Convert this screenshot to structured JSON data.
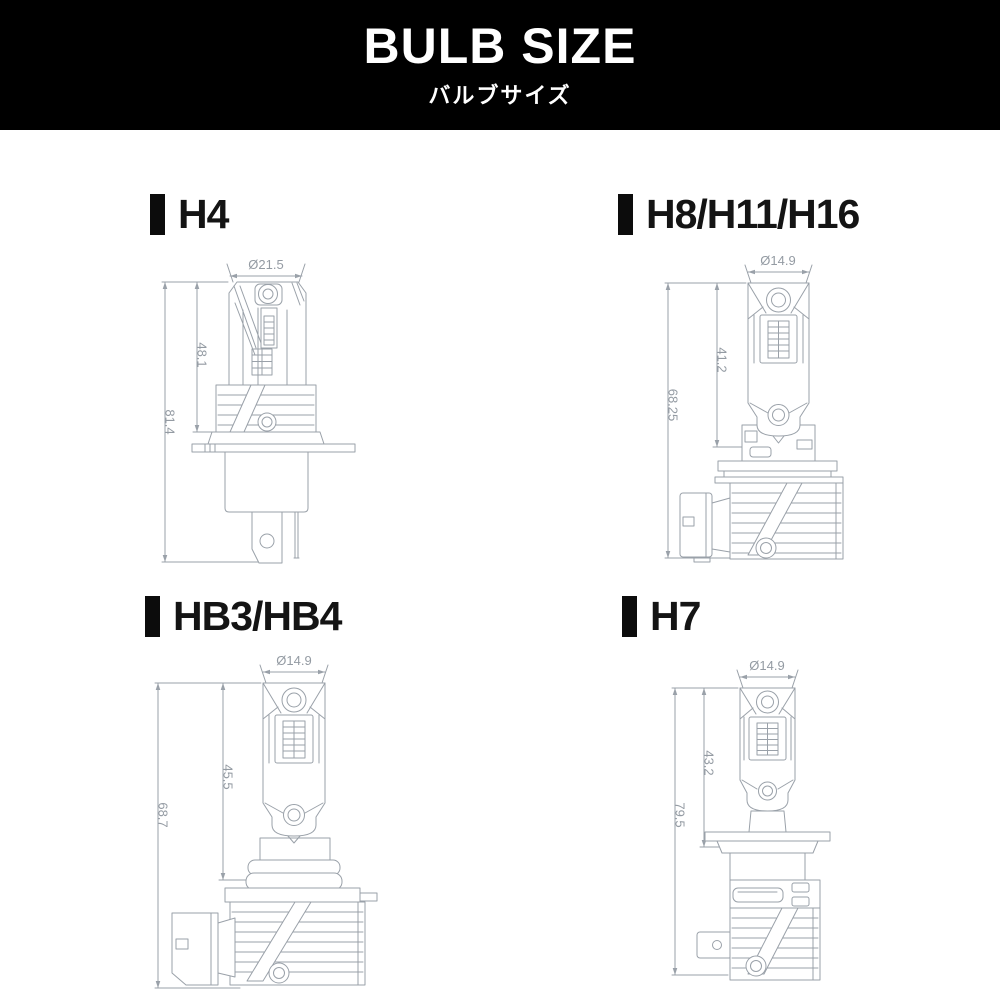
{
  "header": {
    "title": "BULB SIZE",
    "subtitle": "バルブサイズ"
  },
  "sections": [
    {
      "id": "h4",
      "label": "H4",
      "dims": {
        "diameter": "Ø21.5",
        "upper": "48.1",
        "overall": "81.4"
      }
    },
    {
      "id": "h8-h11-h16",
      "label": "H8/H11/H16",
      "dims": {
        "diameter": "Ø14.9",
        "upper": "41.2",
        "overall": "68.25"
      }
    },
    {
      "id": "hb3-hb4",
      "label": "HB3/HB4",
      "dims": {
        "diameter": "Ø14.9",
        "upper": "45.5",
        "overall": "68.7"
      }
    },
    {
      "id": "h7",
      "label": "H7",
      "dims": {
        "diameter": "Ø14.9",
        "upper": "43.2",
        "overall": "79.5"
      }
    }
  ],
  "colors": {
    "header_bg": "#000000",
    "header_text": "#ffffff",
    "label_text": "#141414",
    "line": "#9aa1a9",
    "dim_text": "#949ba3",
    "background": "#ffffff"
  }
}
